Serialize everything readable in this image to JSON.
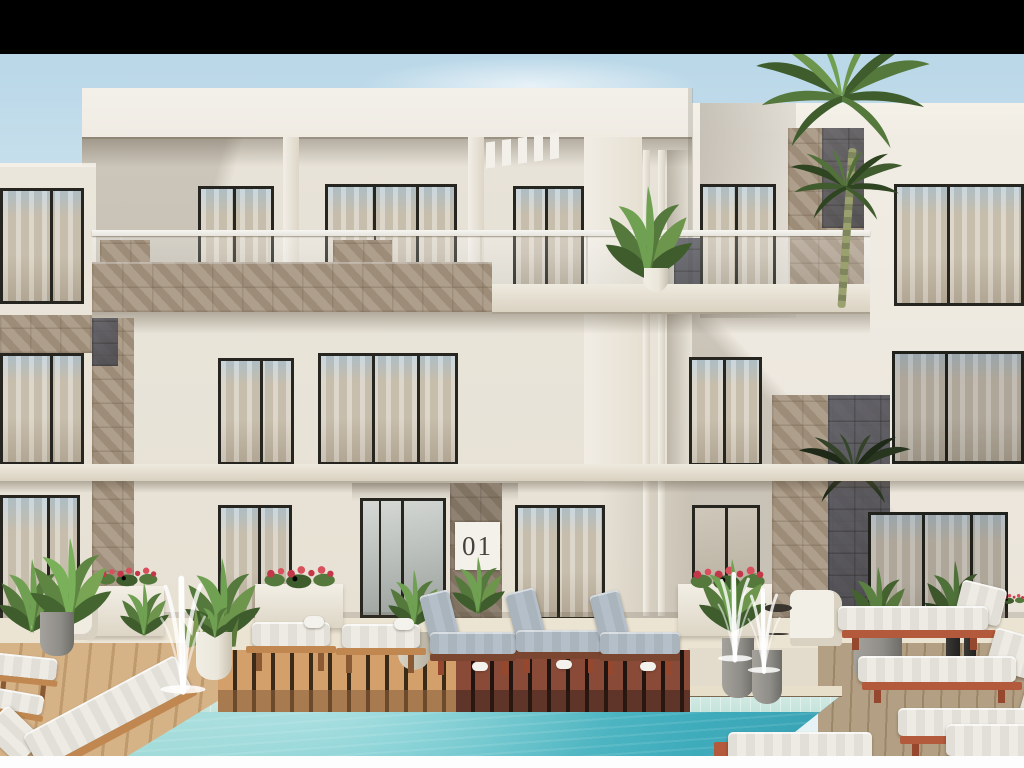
{
  "scene": {
    "title": "Architectural rendering: modern three-storey apartment building with pool terrace",
    "plaque": {
      "text": "01"
    },
    "letterbox": {
      "top": "black bar",
      "bottom": "white strip"
    },
    "objects": [
      "black letterbox bar",
      "blue sky",
      "white modern facade",
      "roof beam with pergola slats",
      "glass balcony railing",
      "stone-clad balcony slab",
      "stone accent columns",
      "floor-to-ceiling windows with sheer curtains",
      "entrance glass doors",
      "unit plaque 01",
      "tall palm tree",
      "balcony banana plant",
      "tropical planters with red flowers",
      "white fountain jets in grey pots",
      "light wood pool deck",
      "dark wood lounger platform",
      "turquoise swimming pool",
      "sun loungers with white cushions",
      "sun loungers with grey-blue cushions",
      "terracotta-frame loungers",
      "rolled towels",
      "white outdoor chair and side table",
      "dark bollards",
      "white bottom strip"
    ]
  },
  "colors": {
    "sky_top": "#b9d7e8",
    "sky_low": "#e6f2f5",
    "facade": "#eae4d9",
    "facade_bright": "#f1ede5",
    "facade_shade": "#d9d2c4",
    "beam": "#f0ece4",
    "band": "#d9d1c0",
    "frame": "#26251f",
    "glass_top": "#b6c9d3",
    "curtain": "#d2c9b8",
    "curtain_dark": "#b9ae9b",
    "stone": "#a79682",
    "slate": "#3d3e46",
    "rail": "#e6e4dc",
    "paving": "#ece4d3",
    "deck_light": "#d6b287",
    "deck_gap": "#bf9a6c",
    "deck_right": "#b3a084",
    "deck_right_gap": "#9c8668",
    "plat_light": "#d39f6a",
    "plat_light_gap": "#3a2a18",
    "plat_dark": "#8a4a38",
    "plat_dark_gap": "#201410",
    "plat_face": "#a87a50",
    "plat_face_dark": "#5f3429",
    "pool_light": "#a5dcd8",
    "pool_mid": "#6cc8cd",
    "pool_deep": "#3facbc",
    "tile": "#c4e4dc",
    "coping": "#e7dfca",
    "cushion": "#edebe3",
    "cushion_gray": "#b4bfc9",
    "wood": "#c08850",
    "terracotta": "#b25a3b",
    "leaf1": "#55793c",
    "leaf2": "#3e5c2c",
    "leaf3": "#6d954c",
    "leaf4": "#70a052",
    "flower": "#c23848",
    "pot_gray": "#8f8d88",
    "pot_white": "#eae6da",
    "white_bar": "#fdfdfd"
  }
}
